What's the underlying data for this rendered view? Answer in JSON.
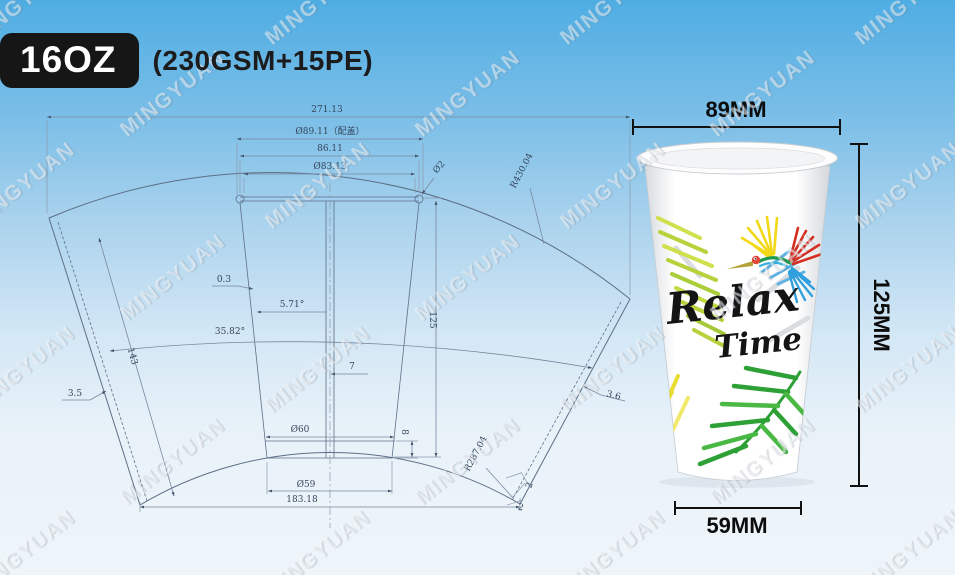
{
  "header": {
    "size_label": "16OZ",
    "spec_label": "(230GSM+15PE)"
  },
  "watermark": {
    "text": "MINGYUAN"
  },
  "drawing": {
    "title": "16oz paper cup fan blank technical drawing",
    "dims": {
      "overall_width": "271.13",
      "rim_with_lid": "Ø89.11（配盖）",
      "rim_outer": "86.11",
      "rim_inner": "Ø83.13",
      "rim_roll": "Ø2",
      "outer_radius": "R430.04",
      "edge_length": "143",
      "gap": "0.3",
      "half_angle": "5.71°",
      "sector_angle": "35.82°",
      "seam_left": "3.5",
      "seam_right": "3.6",
      "wall_height": "125",
      "center_half": "7",
      "bottom_outer": "Ø60",
      "band_height": "8",
      "bottom_inner": "Ø59",
      "inner_radius": "R287.04",
      "bottom_chord": "183.18",
      "corner_a": "2",
      "corner_b": "2"
    }
  },
  "cup": {
    "art_line1": "Relax",
    "art_line2": "Time",
    "dim_top": "89MM",
    "dim_height": "125MM",
    "dim_bottom": "59MM",
    "colors": {
      "leaf_green": "#2da036",
      "leaf_lime": "#b7d23d",
      "leaf_yellow": "#e8dc30",
      "bird_red": "#d62f22",
      "bird_yellow": "#f2d818",
      "bird_blue": "#2f9fdd",
      "cup_white": "#ffffff",
      "dim_black": "#0d0d0d",
      "bg_top_blue": "#4fade3",
      "bg_bottom": "#eef5fa"
    }
  }
}
